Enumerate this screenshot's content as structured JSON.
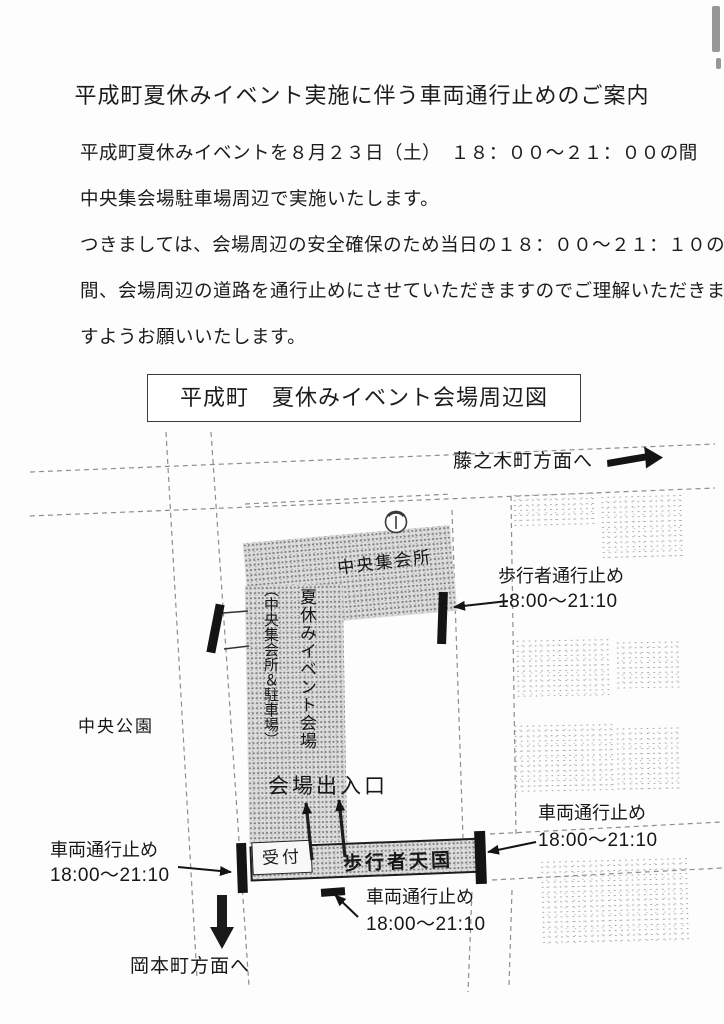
{
  "doc": {
    "title": "平成町夏休みイベント実施に伴う車両通行止めのご案内",
    "body_lines": [
      "平成町夏休みイベントを８月２３日（土）　１８：００～２１：００の間",
      "中央集会場駐車場周辺で実施いたします。",
      "つきましては、会場周辺の安全確保のため当日の１８：００～２１：１０の",
      "間、会場周辺の道路を通行止めにさせていただきますのでご理解いただきま",
      "すようお願いいたします。"
    ],
    "map_title": "平成町　夏休みイベント会場周辺図"
  },
  "map": {
    "labels": {
      "to_fujinokicho": "藤之木町方面へ",
      "central_meeting_hall": "中央集会所",
      "event_venue_vertical": "夏休みイベント会場",
      "event_venue_note_vertical": "（中央集会所＆駐車場）",
      "venue_entrance": "会場出入口",
      "central_park": "中央公園",
      "pedestrian_closure": "歩行者通行止め",
      "closure_time": "18:00～21:10",
      "vehicle_closure": "車両通行止め",
      "pedestrian_mall": "歩行者天国",
      "reception": "受付",
      "to_okamotocho": "岡本町方面へ"
    },
    "colors": {
      "closure_marker": "#141414",
      "venue_fill": "#dcdcdc",
      "building_fill": "#ececec"
    }
  }
}
